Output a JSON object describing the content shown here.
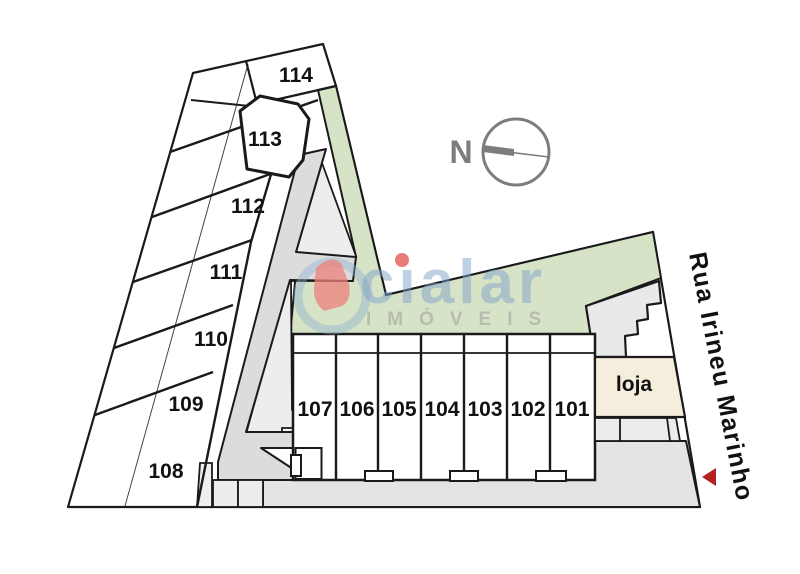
{
  "plan": {
    "compass_label": "N",
    "street_name": "Rua Irineu Marinho",
    "loja_label": "loja",
    "units_row": [
      "107",
      "106",
      "105",
      "104",
      "103",
      "102",
      "101"
    ],
    "units_strip": [
      "108",
      "109",
      "110",
      "111",
      "112",
      "113",
      "114"
    ]
  },
  "watermark": {
    "brand": "cialar",
    "brand_display": "cıalar",
    "tagline": "IMÓVEIS"
  },
  "colors": {
    "landscape_green": "#d6e3c6",
    "walkway_gray": "#dcdcdc",
    "light_paving_gray": "#ededed",
    "sidewalk_gray": "#e4e4e4",
    "entrance_gray": "#e9e9e9",
    "loja_beige": "#f6eedd",
    "outline_black": "#1a1a1a",
    "compass_gray": "#7d7d7d",
    "marker_red": "#b32222",
    "watermark_blue": "#7da2ca",
    "watermark_red": "#e8645f"
  }
}
